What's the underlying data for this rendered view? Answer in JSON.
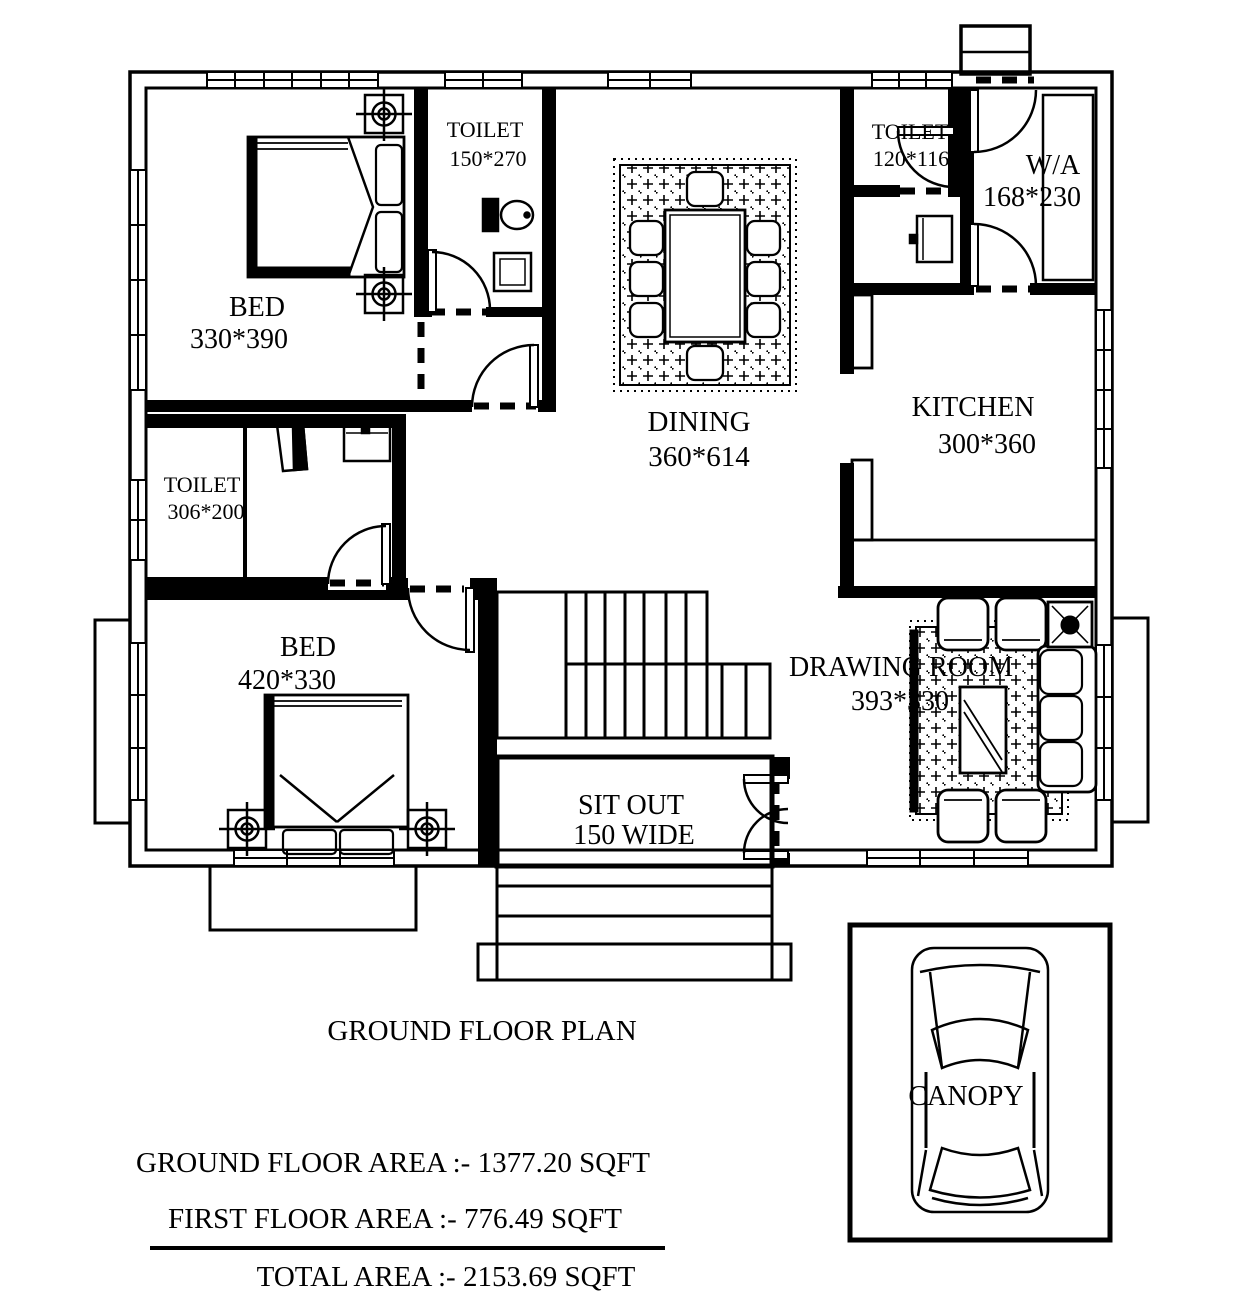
{
  "plan": {
    "title": "GROUND FLOOR PLAN",
    "rooms": [
      {
        "name": "BED",
        "dims": "330*390"
      },
      {
        "name": "TOILET",
        "dims": "150*270"
      },
      {
        "name": "DINING",
        "dims": "360*614"
      },
      {
        "name": "TOILET",
        "dims": "120*116"
      },
      {
        "name": "W/A",
        "dims": "168*230"
      },
      {
        "name": "KITCHEN",
        "dims": "300*360"
      },
      {
        "name": "TOILET",
        "dims": "306*200"
      },
      {
        "name": "BED",
        "dims": "420*330"
      },
      {
        "name": "SIT OUT",
        "dims": "150 WIDE"
      },
      {
        "name": "DRAWING ROOM",
        "dims": "393*330"
      },
      {
        "name": "CANOPY",
        "dims": ""
      }
    ],
    "areas": {
      "ground_floor": "GROUND FLOOR  AREA :- 1377.20 SQFT",
      "first_floor": "FIRST FLOOR  AREA :-  776.49 SQFT",
      "total": "TOTAL AREA :- 2153.69 SQFT"
    }
  },
  "colors": {
    "ink": "#000000",
    "paper": "#ffffff"
  }
}
